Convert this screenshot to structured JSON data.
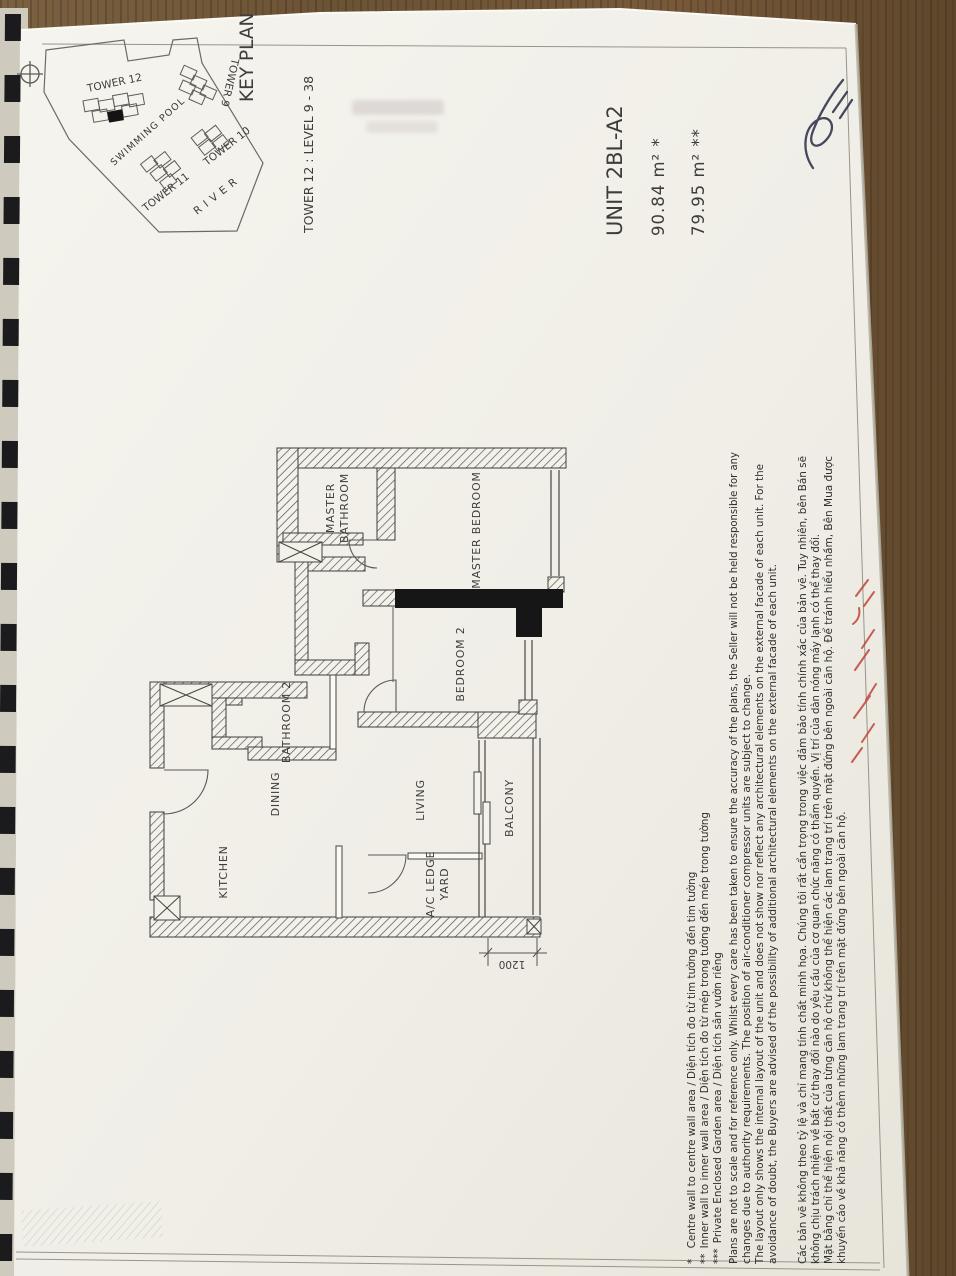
{
  "key_plan": {
    "title": "KEY PLAN",
    "tower12": "TOWER 12",
    "tower9": "TOWER 9",
    "tower10": "TOWER 10",
    "tower11": "TOWER 11",
    "swimming_pool": "SWIMMING POOL",
    "river": "RIVER"
  },
  "header": {
    "tower_level": "TOWER 12 : LEVEL 9 - 38",
    "unit": "UNIT 2BL-A2",
    "area_outer": "90.84 m² *",
    "area_inner": "79.95 m² **"
  },
  "plan": {
    "rooms": {
      "master_word": "MASTER",
      "bathroom_word": "BATHROOM",
      "master_bedroom": "MASTER BEDROOM",
      "bedroom2": "BEDROOM 2",
      "bathroom2": "BATHROOM 2",
      "dining": "DINING",
      "kitchen": "KITCHEN",
      "living": "LIVING",
      "balcony": "BALCONY",
      "ac_ledge": "A/C LEDGE",
      "yard": "YARD"
    },
    "dimension_1200": "1200"
  },
  "footnotes": {
    "en": [
      "*  Centre wall to centre wall area / Diện tích đo từ tim tường đến tim tường",
      "** Inner wall to inner wall area / Diện tích đo từ mép trong tường đến mép trong tường",
      "*** Private Enclosed Garden area / Diện tích sân vườn riêng",
      "Plans are not to scale and for reference only. Whilst every care has been taken to ensure the accuracy of the plans, the Seller will not be held responsible for any",
      "changes due to authority requirements. The position of air-conditioner compressor units are subject to change.",
      "The layout only shows the internal layout of the unit and does not show nor reflect any architectural elements on the external facade of each unit. For the",
      "avoidance of doubt, the Buyers are advised of the possibility of additional architectural elements on the external facade of each unit."
    ],
    "vn": [
      "Các bản vẽ không theo tỷ lệ và chỉ mang tính chất minh họa. Chúng tôi rất cẩn trọng trong việc đảm bảo tính chính xác của bản vẽ. Tuy nhiên, bên Bán sẽ",
      "không chịu trách nhiệm về bất cứ thay đổi nào do yêu cầu của cơ quan chức năng có thẩm quyền. Vị trí của dàn nóng máy lạnh có thể thay đổi.",
      "Mặt bằng chỉ thể hiện nội thất của từng căn hộ chứ không thể hiện các lam trang trí trên mặt đứng bên ngoài căn hộ. Để tránh hiểu nhầm, Bên Mua được",
      "khuyến cáo về khả năng có thêm những lam trang trí trên mặt đứng bên ngoài căn hộ."
    ]
  },
  "colors": {
    "paper": "#f2f0ea",
    "ink": "#3d3d3b",
    "wood": "#6e5538",
    "binding": "#1b1b1d",
    "red_ink": "#c0453a",
    "signature_ink": "#35354e"
  }
}
